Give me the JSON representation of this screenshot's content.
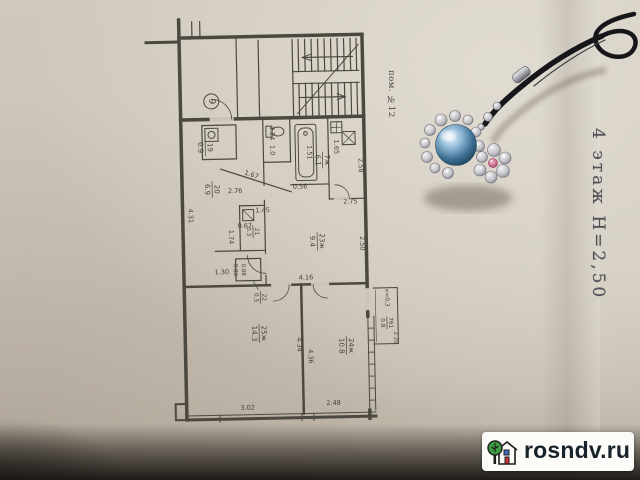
{
  "photo": {
    "stamp_vertical": "4 этаж Н=2,50",
    "premise_label": "пом. №12",
    "watermark_text": "rosndv.ru"
  },
  "plan": {
    "circled_number": "9",
    "rooms": [
      {
        "num": "19",
        "den": "0.9"
      },
      {
        "num": "20",
        "den": "6.9"
      },
      {
        "num": "7ж",
        "den": "6.1"
      },
      {
        "num": "21",
        "den": "0.3"
      },
      {
        "num": "23ж",
        "den": "9.4"
      },
      {
        "num": "22",
        "den": "0.5"
      },
      {
        "num": "25ж",
        "den": "14.3"
      },
      {
        "num": "24ж",
        "den": "10.8"
      },
      {
        "num": "7б1",
        "den": "0.8"
      }
    ],
    "balcony_coef": "к=0,3",
    "dims": {
      "d124": "1.24",
      "d10": "1.0",
      "d151": "1.51",
      "d165": "1.65",
      "d258": "2.58",
      "d056": "0.56",
      "d167": "1.67",
      "d276": "2.76",
      "d145": "1.45",
      "d275": "2.75",
      "d067": "0.67",
      "d174": "1.74",
      "d431": "4.31",
      "d130": "1.30",
      "d080": "0.80",
      "d088": "0.88",
      "d250": "2.50",
      "d416": "4.16",
      "d434": "4.34",
      "d436": "4.36",
      "d302": "3.02",
      "d248": "2.48",
      "d220": "2.20"
    }
  },
  "colors": {
    "paper": "#ccc4b7",
    "ink": "#45423a",
    "pearl_blue": "#5e8fb5",
    "gem_pink": "#c75f86",
    "cord_black": "#17161a",
    "logo_green": "#3f9b40",
    "logo_red": "#cc3333",
    "logo_blue": "#3a6bc9",
    "watermark_bg": "#fbfbf8"
  }
}
